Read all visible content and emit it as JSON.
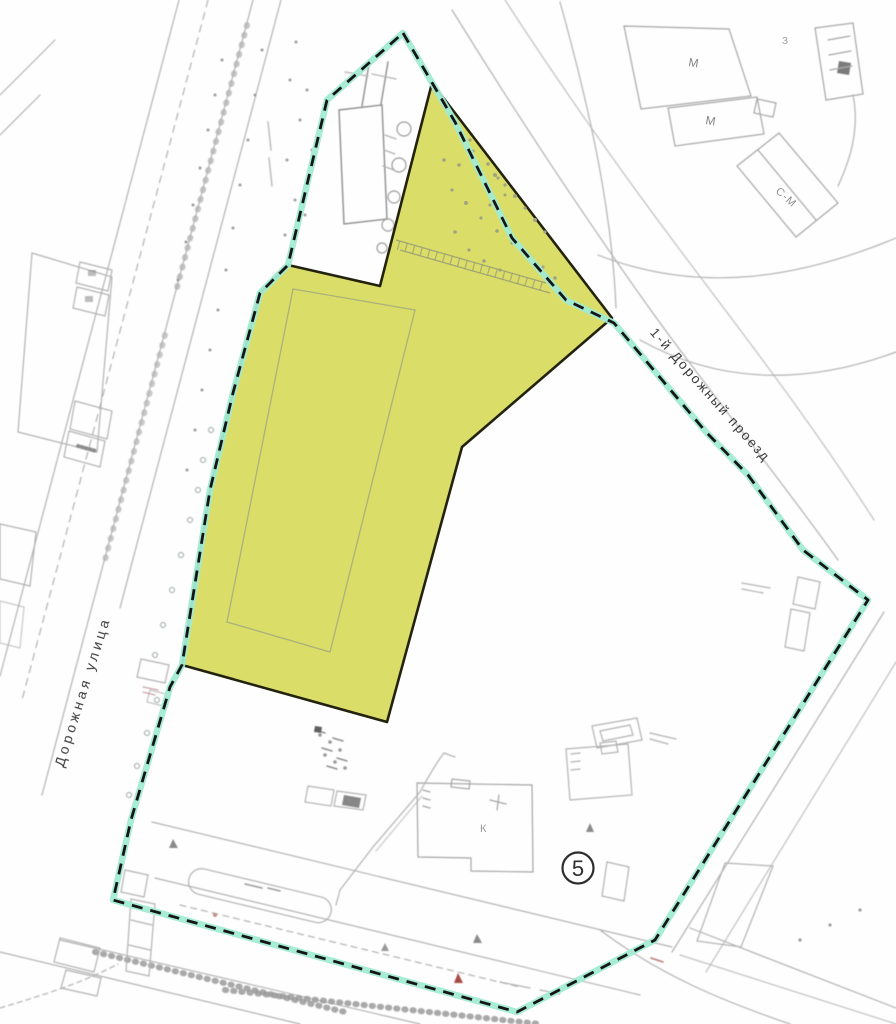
{
  "labels": {
    "street_left": "Дорожная улица",
    "street_right": "1-й Дорожный проезд",
    "building_m1": "М",
    "building_m2": "М",
    "building_z": "З",
    "building_sm": "С-М",
    "building_k": "К",
    "site_marker": "5"
  },
  "colors": {
    "parcel_fill": "#dade68",
    "parcel_stroke": "#24240f",
    "boundary_teal": "#a2ebd2",
    "boundary_dash": "#161616",
    "linework": "#b2b2b2",
    "label_dark": "#3c3c3c",
    "label_gray": "#8d8d8d",
    "red_mark": "#a84c44"
  },
  "geometry": {
    "boundary_points": "403,33 455,122 512,238 566,300 614,323 706,432 748,475 803,550 868,600 655,940 517,1012 113,900 131,820 170,687 182,665 210,490 233,393 260,293 288,265 327,100",
    "parcel_points": "432,83 612,318 462,447 387,722 182,665 210,490 233,393 260,293 288,265 380,286",
    "inner_outline_points": "293,289 415,310 330,652 227,622"
  }
}
